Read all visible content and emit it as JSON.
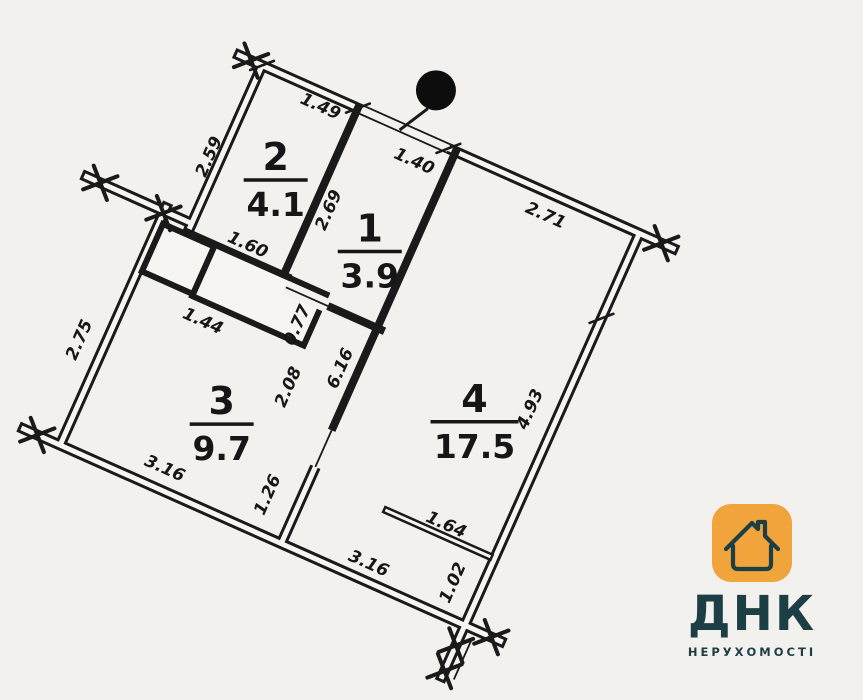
{
  "plan": {
    "rooms": [
      {
        "number": "2",
        "area": "4.1"
      },
      {
        "number": "1",
        "area": "3.9"
      },
      {
        "number": "3",
        "area": "9.7"
      },
      {
        "number": "4",
        "area": "17.5"
      }
    ],
    "dimensions": {
      "top_room2": "1.49",
      "left_room2": "2.59",
      "entrance_door": "1.40",
      "top_room4": "2.71",
      "left_room1": "2.69",
      "closet_width": "1.60",
      "closet_depth": "0.77",
      "closet_bottom": "1.44",
      "left_room3": "2.75",
      "corridor": "2.08",
      "room4_wall": "6.16",
      "right_room4": "4.93",
      "bottom_room3": "3.16",
      "bottom_stub": "1.26",
      "bottom_room4": "3.16",
      "balcony_wall": "1.64",
      "bottom_right": "1.02"
    }
  },
  "logo": {
    "brand": "ДНК",
    "tagline": "НЕРУХОМОСТІ",
    "icon_color": "#F2A43C",
    "text_color": "#1C3F46"
  }
}
